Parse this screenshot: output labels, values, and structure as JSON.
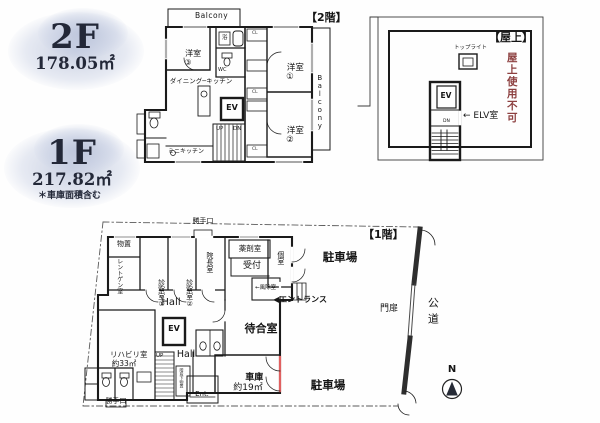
{
  "legend": {
    "f2_label": "2F",
    "f2_area": "178.05㎡",
    "f1_label": "1F",
    "f1_area": "217.82㎡",
    "f1_note": "＊車庫面積含む"
  },
  "plan2f": {
    "title": "【2階】",
    "balcony_top": "Balcony",
    "balcony_right": "Balcony",
    "room3_name": "洋室",
    "room3_no": "③",
    "room1_name": "洋室",
    "room1_no": "①",
    "room2_name": "洋室",
    "room2_no": "②",
    "dining_kitchen": "ダイニング─キッチン",
    "elevator": "EV",
    "up": "UP",
    "down": "DN",
    "mini_kitchen": "ミニキッチン",
    "wc": "WC",
    "bath": "浴",
    "closet": "CL"
  },
  "roof": {
    "title": "【屋上】",
    "skylight": "トップライト",
    "elevator": "EV",
    "down": "DN",
    "elv_room": "← ELV室",
    "warning": "屋上使用不可",
    "warning_color": "#8d4040"
  },
  "plan1f": {
    "title": "【1階】",
    "back_door_top": "勝手口",
    "storage": "物置",
    "xray_room": "レントゲン室",
    "exam1_name": "診察室",
    "exam1_no": "①",
    "exam2_name": "診察室",
    "exam2_no": "②",
    "director_room": "院長室",
    "pharmacy": "薬剤室",
    "reception": "受付",
    "private_room": "個室",
    "windbreak": "←風除室",
    "entrance": "◀エントランス",
    "hall_upper": "Hall",
    "waiting_room": "待合室",
    "rehab_name": "リハビリ室",
    "rehab_area": "約33㎡",
    "elevator": "EV",
    "up": "UP",
    "hall_lower": "Hall",
    "understair": "階段下物置",
    "garage_name": "車庫",
    "garage_area": "約19㎡",
    "ent": "Ent.",
    "back_door_bottom": "勝手口",
    "parking_upper": "駐車場",
    "parking_lower": "駐車場",
    "gate": "門扉",
    "road": "公道",
    "north": "N"
  }
}
